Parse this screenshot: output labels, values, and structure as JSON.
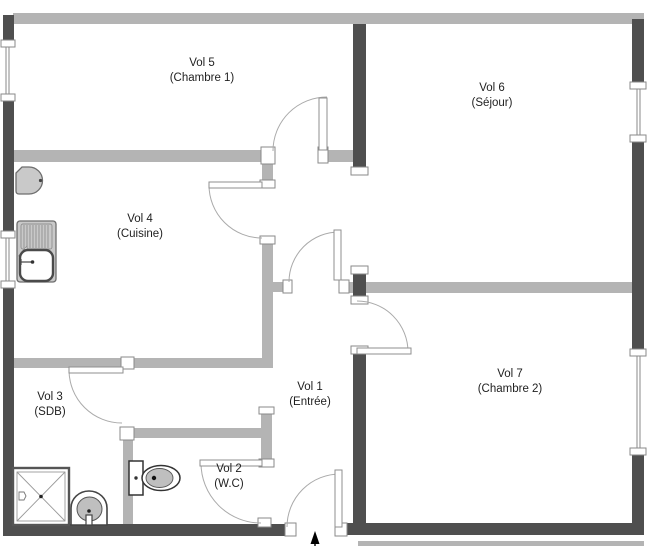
{
  "plan": {
    "rooms": [
      {
        "id": "vol5",
        "line1": "Vol 5",
        "line2": "(Chambre 1)"
      },
      {
        "id": "vol6",
        "line1": "Vol 6",
        "line2": "(Séjour)"
      },
      {
        "id": "vol4",
        "line1": "Vol 4",
        "line2": "(Cuisine)"
      },
      {
        "id": "vol1",
        "line1": "Vol 1",
        "line2": "(Entrée)"
      },
      {
        "id": "vol7",
        "line1": "Vol 7",
        "line2": "(Chambre 2)"
      },
      {
        "id": "vol3",
        "line1": "Vol 3",
        "line2": "(SDB)"
      },
      {
        "id": "vol2",
        "line1": "Vol 2",
        "line2": "(W.C)"
      }
    ],
    "fixtures": [
      "water-heater",
      "kitchen-sink",
      "shower",
      "washbasin",
      "toilet"
    ],
    "compass": "north-arrow",
    "colors": {
      "wall_dark": "#4f4f4f",
      "wall_light": "#b4b4b4",
      "fixture_fill": "#c9c9c9",
      "line": "#9a9a9a",
      "text": "#1f1f1f",
      "bg": "#ffffff"
    }
  }
}
